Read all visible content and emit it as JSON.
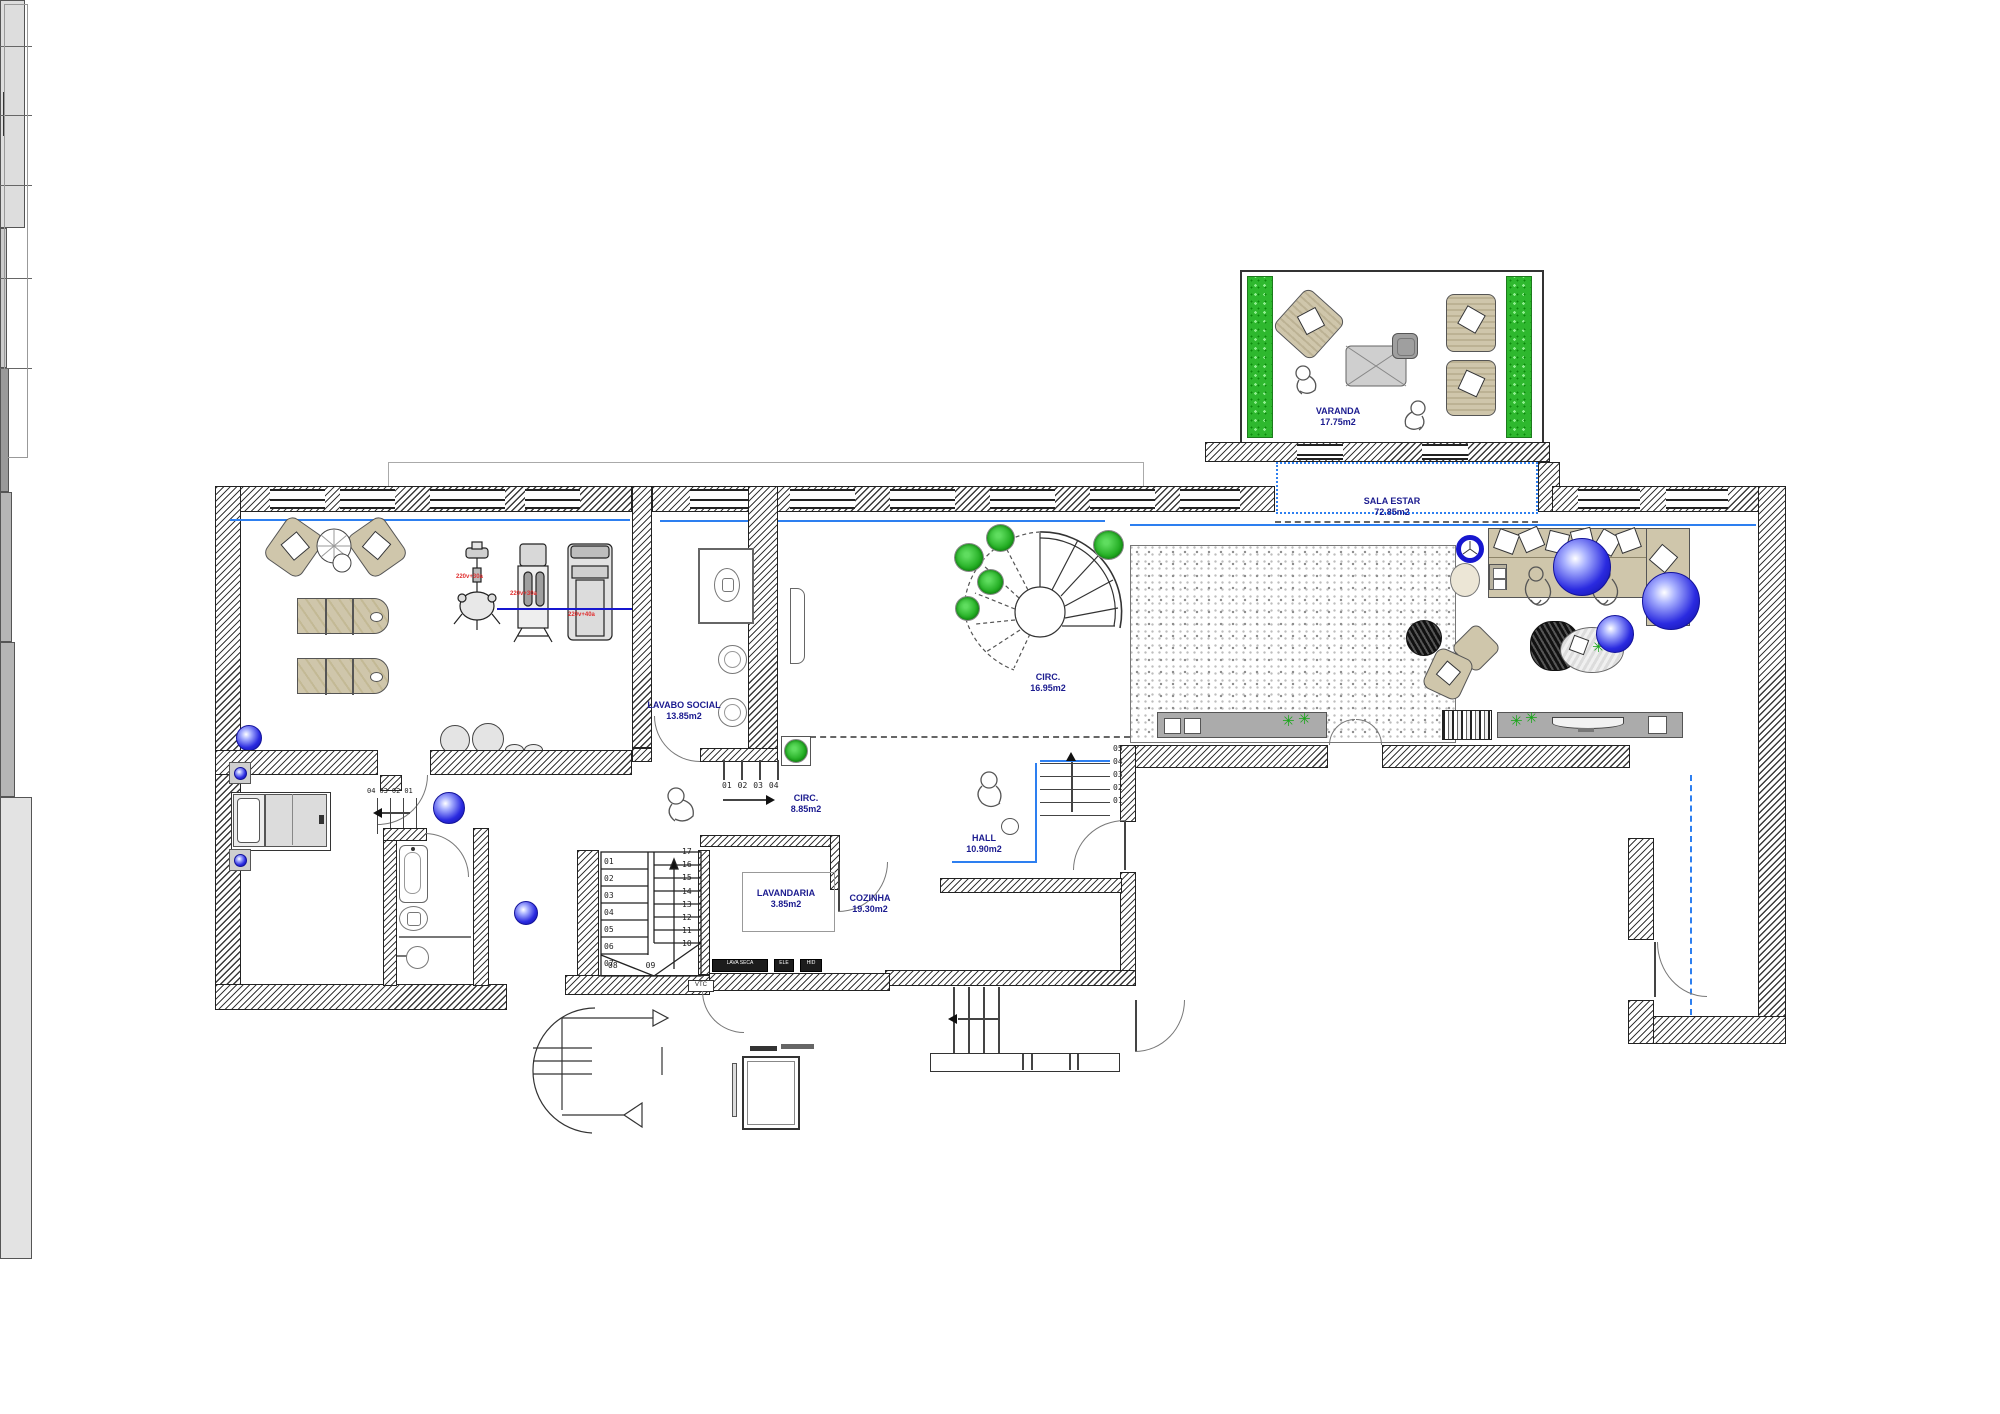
{
  "rooms": {
    "varanda": {
      "name": "VARANDA",
      "area": "17.75m2"
    },
    "sala_estar": {
      "name": "SALA ESTAR",
      "area": "72.85m2"
    },
    "lavabo_social": {
      "name": "LAVABO SOCIAL",
      "area": "13.85m2"
    },
    "circ_upper": {
      "name": "CIRC.",
      "area": "16.95m2"
    },
    "circ_lower": {
      "name": "CIRC.",
      "area": "8.85m2"
    },
    "hall": {
      "name": "HALL",
      "area": "10.90m2"
    },
    "lavandaria": {
      "name": "LAVANDARIA",
      "area": "3.85m2"
    },
    "cozinha": {
      "name": "COZINHA",
      "area": "19.30m2"
    }
  },
  "stairs": {
    "main_left": [
      "01",
      "02",
      "03",
      "04",
      "05",
      "06",
      "07"
    ],
    "main_bottom": [
      "08",
      "09"
    ],
    "main_right": [
      "17",
      "16",
      "15",
      "14",
      "13",
      "12",
      "11",
      "10"
    ],
    "entry_steps": [
      "01",
      "02",
      "03",
      "04"
    ],
    "hall_steps": [
      "05",
      "04",
      "03",
      "02",
      "01"
    ],
    "bedroom_steps": [
      "04",
      "03",
      "02",
      "01"
    ]
  },
  "annotations": {
    "machine_labels": [
      "220v+30a",
      "220v+30a",
      "220v+40a"
    ],
    "appliance_labels": [
      "LAVA SECA",
      "ELE",
      "HID"
    ],
    "duct_label": "VTC"
  },
  "icons": {
    "plant_asterisk": "✳"
  },
  "colors": {
    "label_navy": "#1b1b8f",
    "annotation_red": "#e03030",
    "plant_green": "#2eb82e",
    "line_blue": "#2d7ff0",
    "sphere_blue": "#1717cf",
    "furniture_tan": "#cfc6ab",
    "wall_hatch": "#444444"
  }
}
